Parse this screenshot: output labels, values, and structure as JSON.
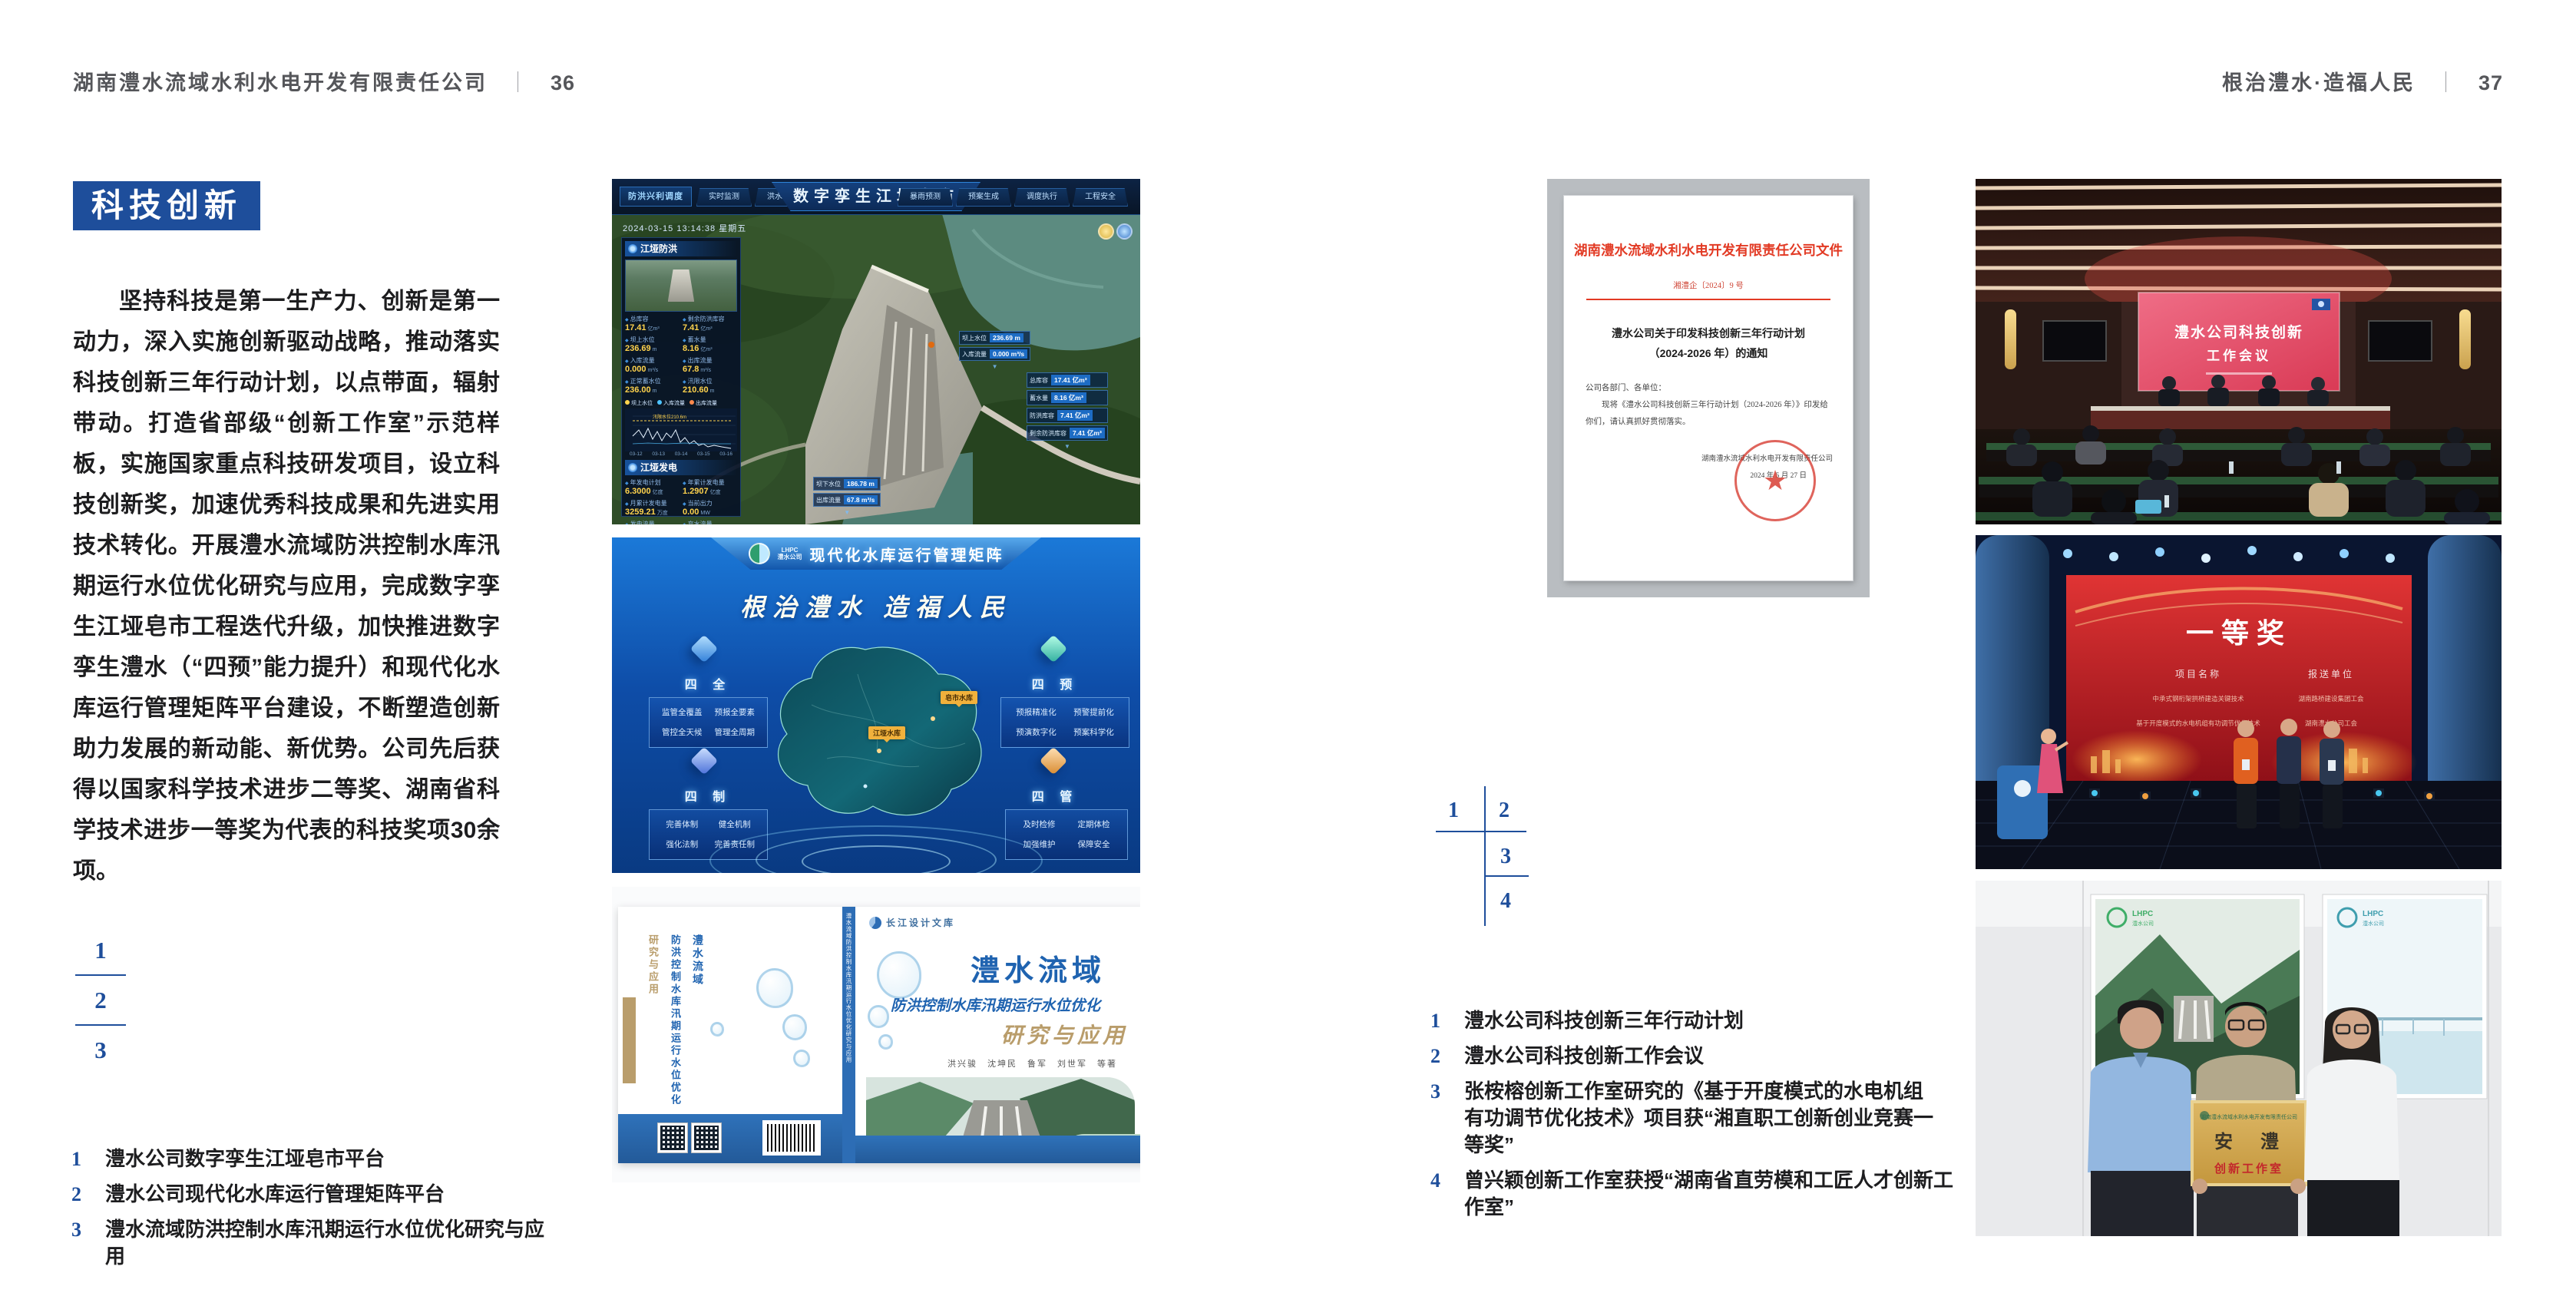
{
  "left_page": {
    "header": "湖南澧水流域水利水电开发有限责任公司",
    "divider": "｜",
    "page_no": "36",
    "section_title": "科技创新",
    "body": "坚持科技是第一生产力、创新是第一动力，深入实施创新驱动战略，推动落实科技创新三年行动计划，以点带面，辐射带动。打造省部级“创新工作室”示范样板，实施国家重点科技研发项目，设立科技创新奖，加速优秀科技成果和先进实用技术转化。开展澧水流域防洪控制水库汛期运行水位优化研究与应用，完成数字孪生江垭皂市工程迭代升级，加快推进数字孪生澧水（“四预”能力提升）和现代化水库运行管理矩阵平台建设，不断塑造创新助力发展的新动能、新优势。公司先后获得以国家科学技术进步二等奖、湖南省科学技术进步一等奖为代表的科技奖项30余项。",
    "index": {
      "n1": "1",
      "n2": "2",
      "n3": "3"
    },
    "captions": [
      {
        "num": "1",
        "text": "澧水公司数字孪生江垭皂市平台"
      },
      {
        "num": "2",
        "text": "澧水公司现代化水库运行管理矩阵平台"
      },
      {
        "num": "3",
        "text": "澧水流域防洪控制水库汛期运行水位优化研究与应用"
      }
    ]
  },
  "right_page": {
    "header": "根治澧水·造福人民",
    "divider": "｜",
    "page_no": "37",
    "index": {
      "n1": "1",
      "n2": "2",
      "n3": "3",
      "n4": "4"
    },
    "captions": [
      {
        "num": "1",
        "text": "澧水公司科技创新三年行动计划"
      },
      {
        "num": "2",
        "text": "澧水公司科技创新工作会议"
      },
      {
        "num": "3",
        "text": "张桉榕创新工作室研究的《基于开度模式的水电机组有功调节优化技术》项目获“湘直职工创新创业竞赛一等奖”"
      },
      {
        "num": "4",
        "text": "曾兴颖创新工作室获授“湖南省直劳模和工匠人才创新工作室”"
      }
    ]
  },
  "fig_dashboard": {
    "title": "数字孪生江垭皂市",
    "tab_home": "防洪兴利调度",
    "nav_left": [
      "实时监测",
      "洪水预报",
      "防洪预警"
    ],
    "nav_right": [
      "暴雨预测",
      "预案生成",
      "调度执行",
      "工程安全"
    ],
    "datetime": "2024-03-15 13:14:38 星期五",
    "panel_flood_title": "江垭防洪",
    "flood_stats": [
      {
        "label": "总库容",
        "value": "17.41",
        "unit": "亿m³"
      },
      {
        "label": "剩余防洪库容",
        "value": "7.41",
        "unit": "亿m³"
      },
      {
        "label": "坝上水位",
        "value": "236.69",
        "unit": "m"
      },
      {
        "label": "蓄水量",
        "value": "8.16",
        "unit": "亿m³"
      },
      {
        "label": "入库流量",
        "value": "0.000",
        "unit": "m³/s"
      },
      {
        "label": "出库流量",
        "value": "67.8",
        "unit": "m³/s"
      },
      {
        "label": "正常蓄水位",
        "value": "236.00",
        "unit": "m"
      },
      {
        "label": "汛限水位",
        "value": "210.60",
        "unit": "m"
      }
    ],
    "chart_legend": [
      "坝上水位",
      "入库流量",
      "出库流量"
    ],
    "chart_annotation": "汛限水位210.6m",
    "chart_x": [
      "03-12",
      "03-13",
      "03-14",
      "03-15",
      "03-16"
    ],
    "panel_power_title": "江垭发电",
    "power_stats": [
      {
        "label": "年发电计划",
        "value": "6.3000",
        "unit": "亿度"
      },
      {
        "label": "年累计发电量",
        "value": "1.2907",
        "unit": "亿度"
      },
      {
        "label": "月累计发电量",
        "value": "3259.21",
        "unit": "万度"
      },
      {
        "label": "当前出力",
        "value": "0.00",
        "unit": "MW"
      },
      {
        "label": "发电流量",
        "value": "0.00",
        "unit": "m³/s"
      },
      {
        "label": "弃水流量",
        "value": "0.00",
        "unit": "m³/s"
      }
    ],
    "callout_up": [
      {
        "label": "坝上水位",
        "value": "236.69 m"
      },
      {
        "label": "入库流量",
        "value": "0.000 m³/s"
      }
    ],
    "callout_cap": [
      {
        "label": "总库容",
        "value": "17.41 亿m³"
      },
      {
        "label": "蓄水量",
        "value": "8.16 亿m³"
      },
      {
        "label": "防洪库容",
        "value": "7.41 亿m³"
      },
      {
        "label": "剩余防洪库容",
        "value": "7.41 亿m³"
      }
    ],
    "callout_down": [
      {
        "label": "坝下水位",
        "value": "186.78 m"
      },
      {
        "label": "出库流量",
        "value": "67.8 m³/s"
      }
    ]
  },
  "fig_matrix": {
    "logo_abbr": "LHPC",
    "logo_name": "澧水公司",
    "header_title": "现代化水库运行管理矩阵",
    "slogan": "根治澧水 造福人民",
    "map_labels": [
      "皂市水库",
      "江垭水库"
    ],
    "groups": [
      {
        "title": "四 全",
        "items": [
          "监管全覆盖",
          "预报全要素",
          "管控全天候",
          "管理全周期"
        ]
      },
      {
        "title": "四 制",
        "items": [
          "完善体制",
          "健全机制",
          "强化法制",
          "完善责任制"
        ]
      },
      {
        "title": "四 预",
        "items": [
          "预报精准化",
          "预警提前化",
          "预演数字化",
          "预案科学化"
        ]
      },
      {
        "title": "四 管",
        "items": [
          "及时检修",
          "定期体检",
          "加强维护",
          "保障安全"
        ]
      }
    ]
  },
  "fig_book": {
    "brand": "长江设计文库",
    "title_main": "澧水流域",
    "title_sub": "防洪控制水库汛期运行水位优化",
    "title_tail": "研究与应用",
    "authors": "洪兴骏　沈坤民　鲁军　刘世军　等著",
    "spine_text": "澧水流域防洪控制水库汛期运行水位优化研究与应用",
    "back_title_1": "澧水流域",
    "back_title_2": "防洪控制水库汛期运行水位优化",
    "back_title_3": "研究与应用"
  },
  "fig_doc": {
    "org_title": "湖南澧水流域水利水电开发有限责任公司文件",
    "doc_no": "湘澧企〔2024〕9 号",
    "title_line1": "澧水公司关于印发科技创新三年行动计划",
    "title_line2": "（2024-2026 年）的通知",
    "salutation": "公司各部门、各单位：",
    "body": "现将《澧水公司科技创新三年行动计划（2024-2026 年）》印发给你们，请认真抓好贯彻落实。",
    "seal_star": "★",
    "signer": "湖南澧水流域水利水电开发有限责任公司",
    "date": "2024 年 5 月 27 日"
  },
  "fig_meeting": {
    "screen_line1": "澧水公司科技创新",
    "screen_line2": "工作会议"
  },
  "fig_stage": {
    "award": "一等奖",
    "col_project": "项目名称",
    "col_unit": "报送单位",
    "rows": [
      {
        "project": "中承式钢桁架拱桥建造关键技术",
        "unit": "湖南路桥建设集团工会"
      },
      {
        "project": "基于开度模式的水电机组有功调节优化技术",
        "unit": "湖南澧水公司工会"
      }
    ]
  },
  "fig_plaque": {
    "poster_logo": "LHPC",
    "poster_logo_name": "澧水公司",
    "plaque_org": "湖南澧水流域水利水电开发有限责任公司",
    "plaque_main": "安　澧",
    "plaque_sub": "创新工作室"
  }
}
